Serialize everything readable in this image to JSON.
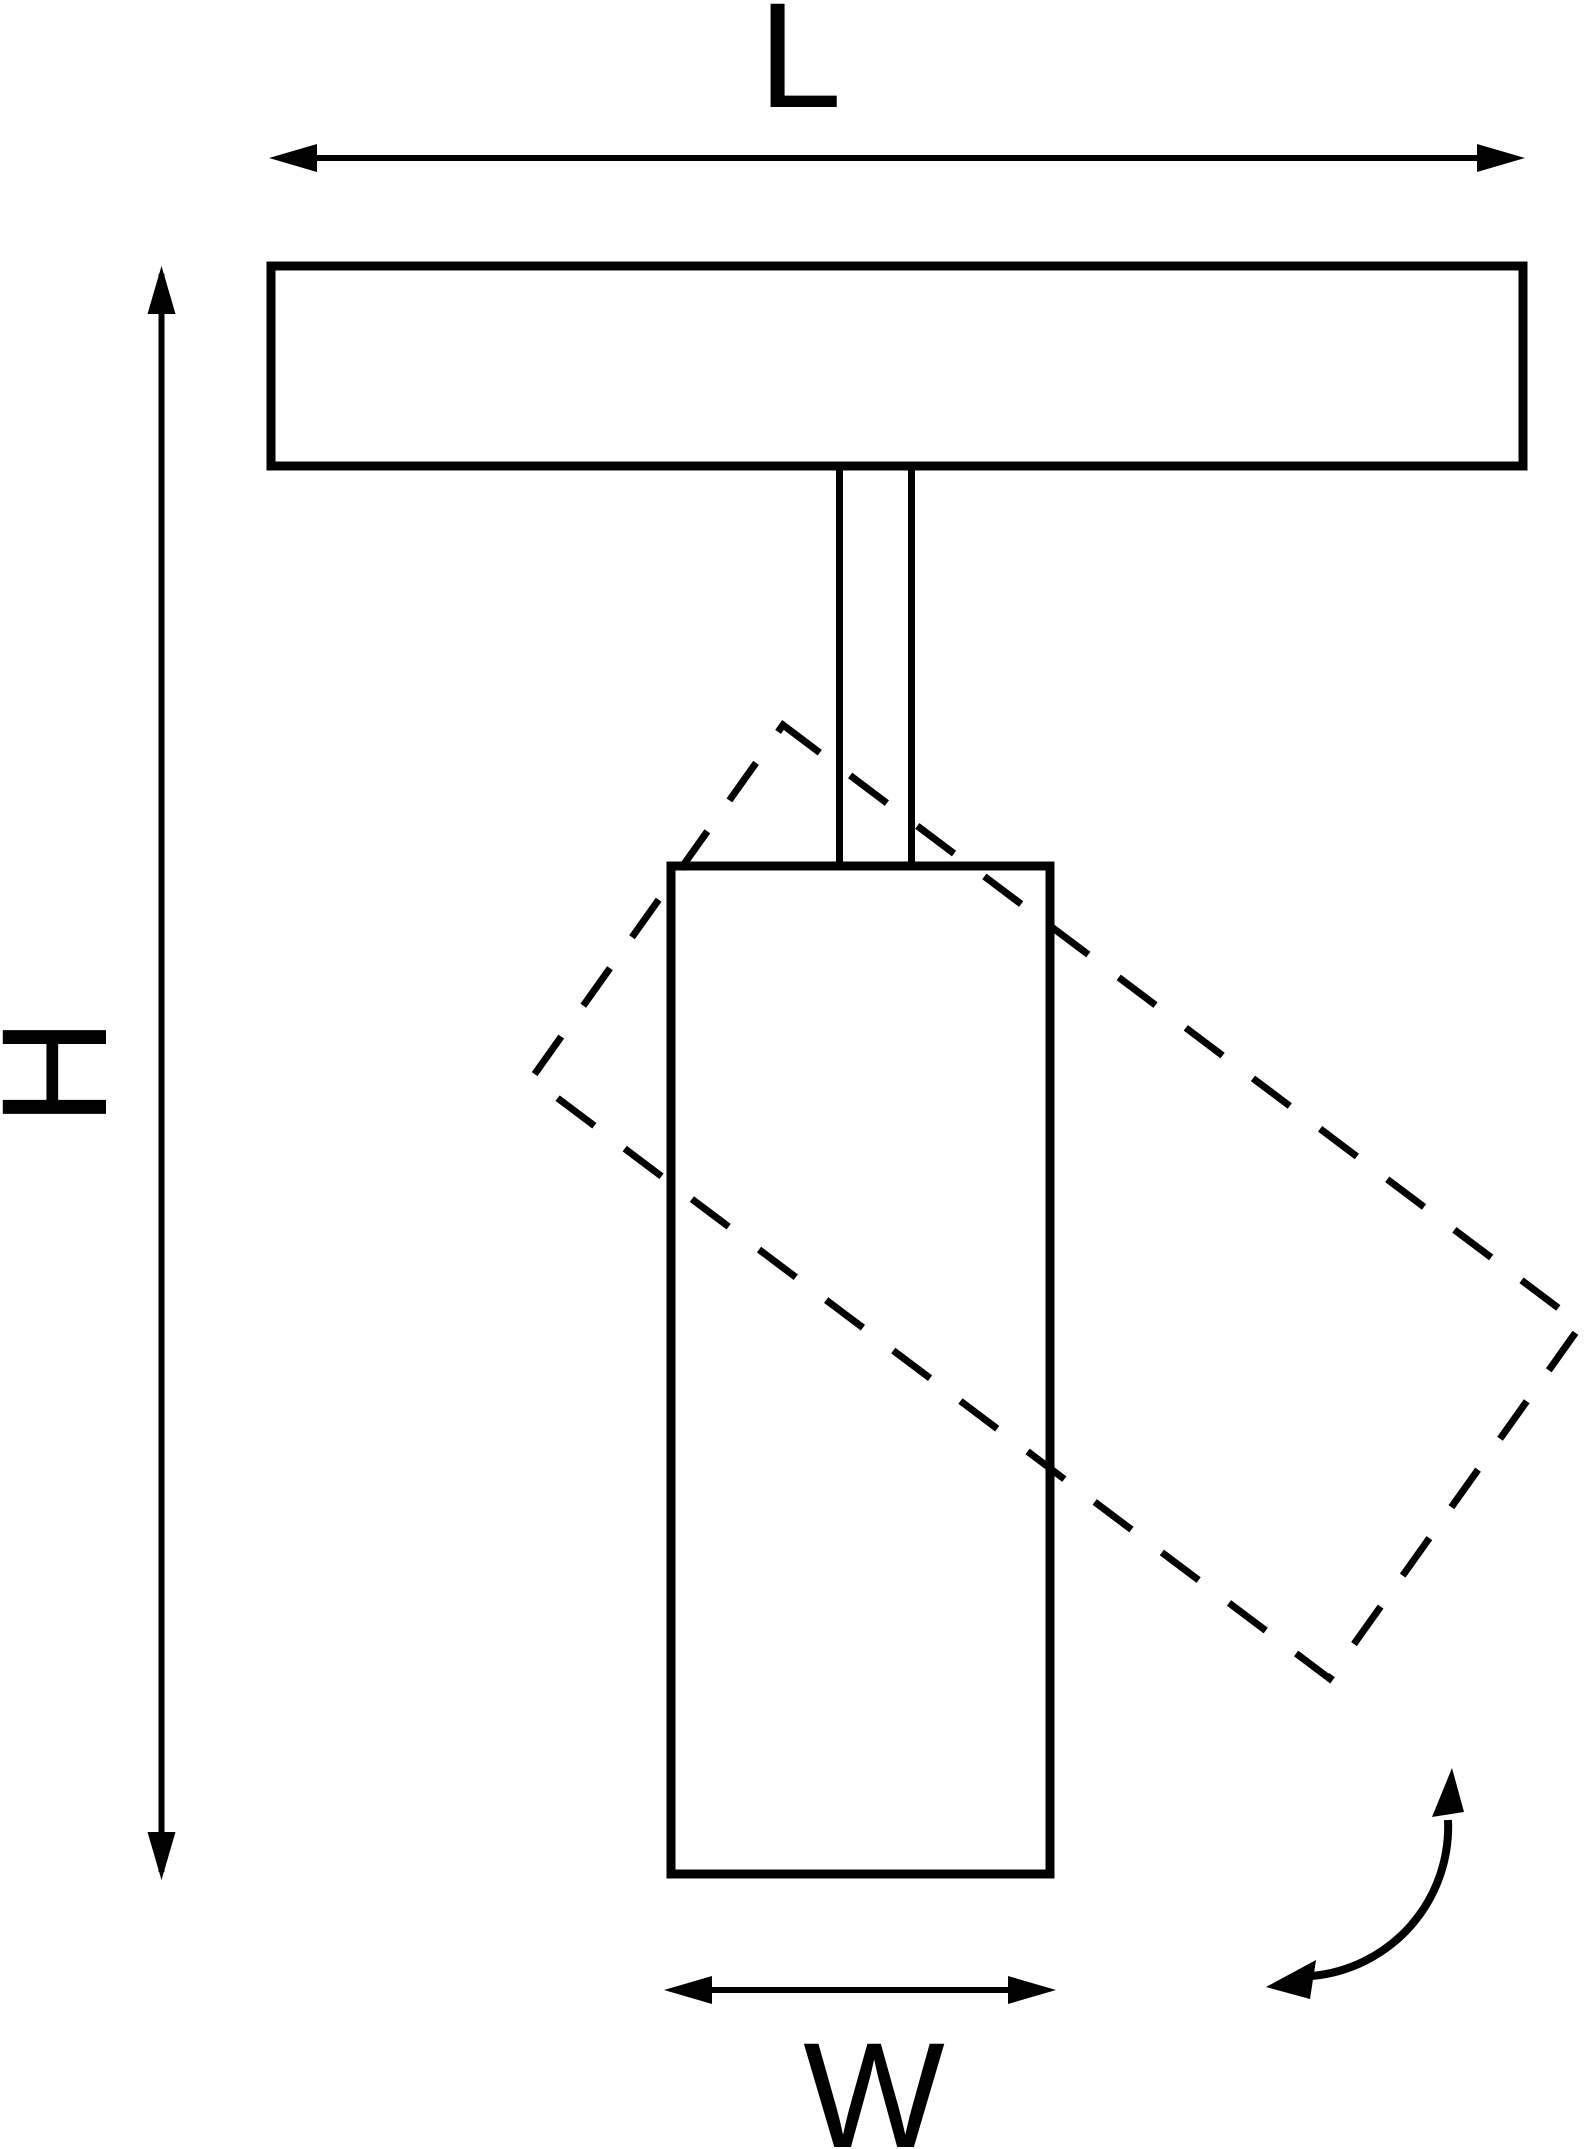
{
  "diagram": {
    "type": "track-spotlight-dimension-drawing",
    "background_color": "#ffffff",
    "line_color": "#000000",
    "labels": {
      "length": "L",
      "height": "H",
      "width": "W"
    }
  }
}
